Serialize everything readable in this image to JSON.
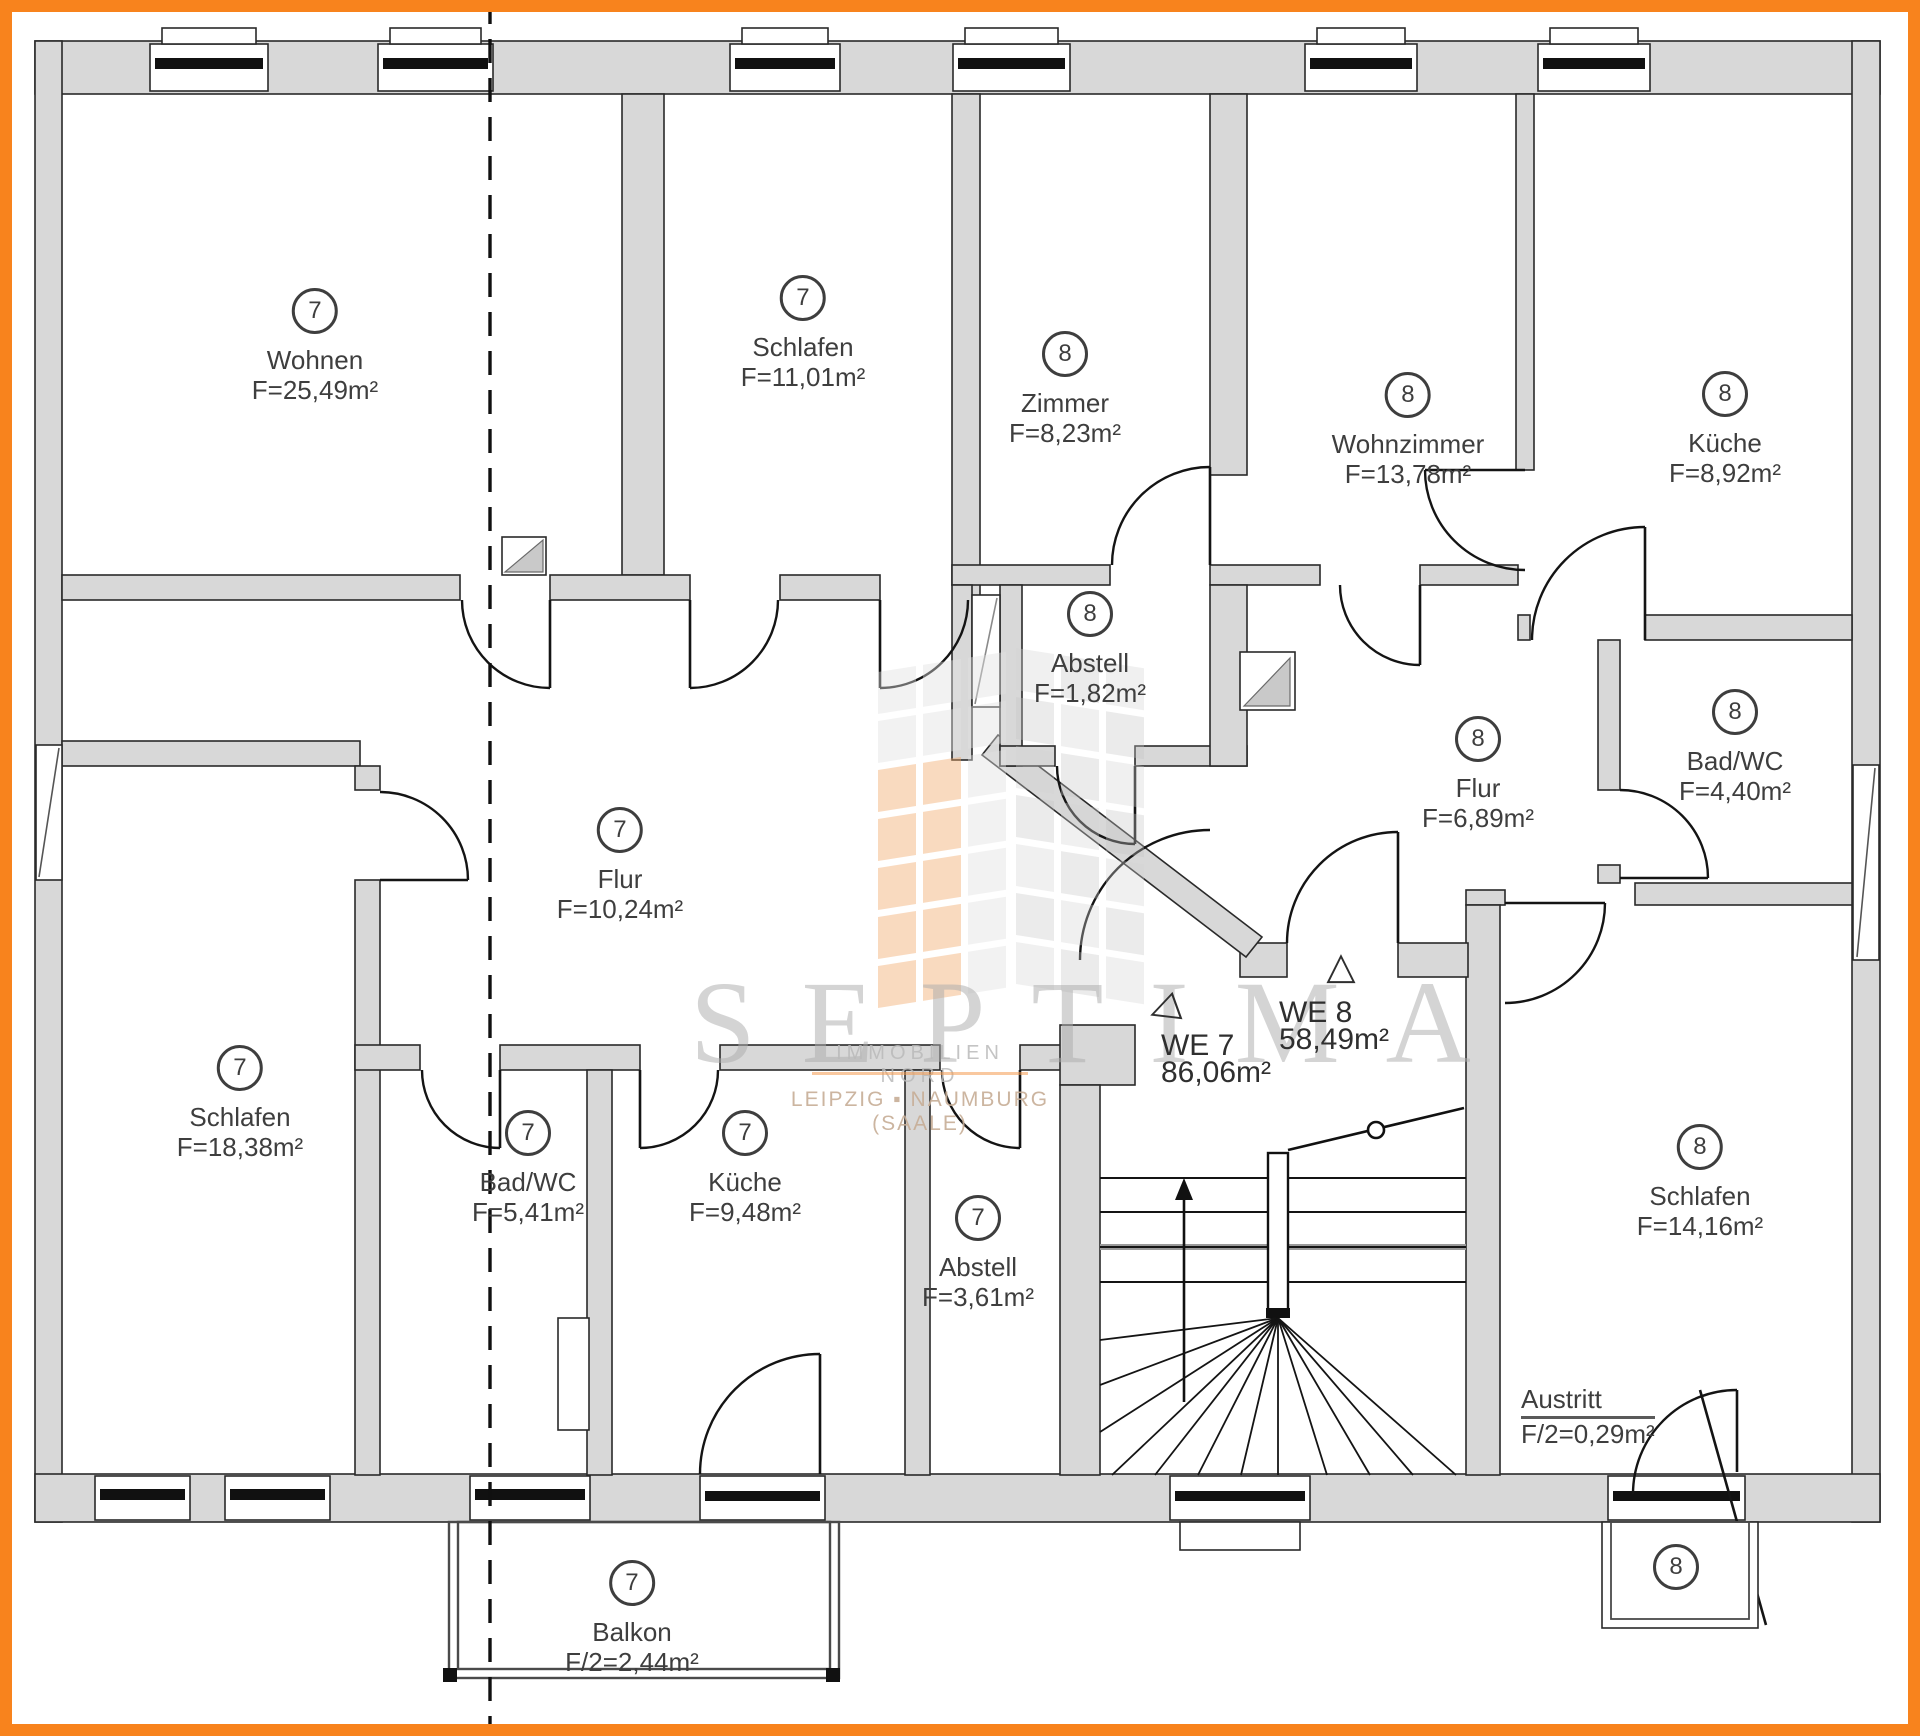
{
  "colors": {
    "frame": "#F8831D",
    "wall_fill": "#D8D8D8",
    "line": "#1E1E1E",
    "text": "#3E3E3E",
    "watermark_gray": "#B9B9B9",
    "watermark_orange": "#F09A50"
  },
  "rooms": [
    {
      "nr": "7",
      "name": "Wohnen",
      "area": "F=25,49m²",
      "x": 315,
      "y": 309
    },
    {
      "nr": "7",
      "name": "Schlafen",
      "area": "F=11,01m²",
      "x": 803,
      "y": 296
    },
    {
      "nr": "8",
      "name": "Zimmer",
      "area": "F=8,23m²",
      "x": 1065,
      "y": 352
    },
    {
      "nr": "8",
      "name": "Wohnzimmer",
      "area": "F=13,78m²",
      "x": 1408,
      "y": 393
    },
    {
      "nr": "8",
      "name": "Küche",
      "area": "F=8,92m²",
      "x": 1725,
      "y": 392
    },
    {
      "nr": "8",
      "name": "Abstell",
      "area": "F=1,82m²",
      "x": 1090,
      "y": 612
    },
    {
      "nr": "8",
      "name": "Flur",
      "area": "F=6,89m²",
      "x": 1478,
      "y": 737
    },
    {
      "nr": "8",
      "name": "Bad/WC",
      "area": "F=4,40m²",
      "x": 1735,
      "y": 710
    },
    {
      "nr": "7",
      "name": "Flur",
      "area": "F=10,24m²",
      "x": 620,
      "y": 828
    },
    {
      "nr": "7",
      "name": "Schlafen",
      "area": "F=18,38m²",
      "x": 240,
      "y": 1066
    },
    {
      "nr": "7",
      "name": "Bad/WC",
      "area": "F=5,41m²",
      "x": 528,
      "y": 1131
    },
    {
      "nr": "7",
      "name": "Küche",
      "area": "F=9,48m²",
      "x": 745,
      "y": 1131
    },
    {
      "nr": "7",
      "name": "Abstell",
      "area": "F=3,61m²",
      "x": 978,
      "y": 1216
    },
    {
      "nr": "8",
      "name": "Schlafen",
      "area": "F=14,16m²",
      "x": 1700,
      "y": 1145
    },
    {
      "nr": "7",
      "name": "Balkon",
      "area": "F/2=2,44m²",
      "x": 632,
      "y": 1581
    }
  ],
  "unit_markers": [
    {
      "id": "we7",
      "label": "WE 7",
      "area": "86,06m²",
      "x": 1216,
      "y": 1046,
      "icon": "triangle-left",
      "tx": 1163,
      "ty": 1008
    },
    {
      "id": "we8",
      "label": "WE 8",
      "area": "58,49m²",
      "x": 1334,
      "y": 1013,
      "icon": "triangle-up",
      "tx": 1341,
      "ty": 966
    }
  ],
  "austritt": {
    "name": "Austritt",
    "area": "F/2=0,29m²"
  },
  "corner_badge": {
    "nr": "8"
  },
  "watermark": {
    "brand": "SEPTIMA",
    "line1": "IMMOBILIEN NORD",
    "line2": "LEIPZIG ▪ NAUMBURG (SAALE)"
  }
}
